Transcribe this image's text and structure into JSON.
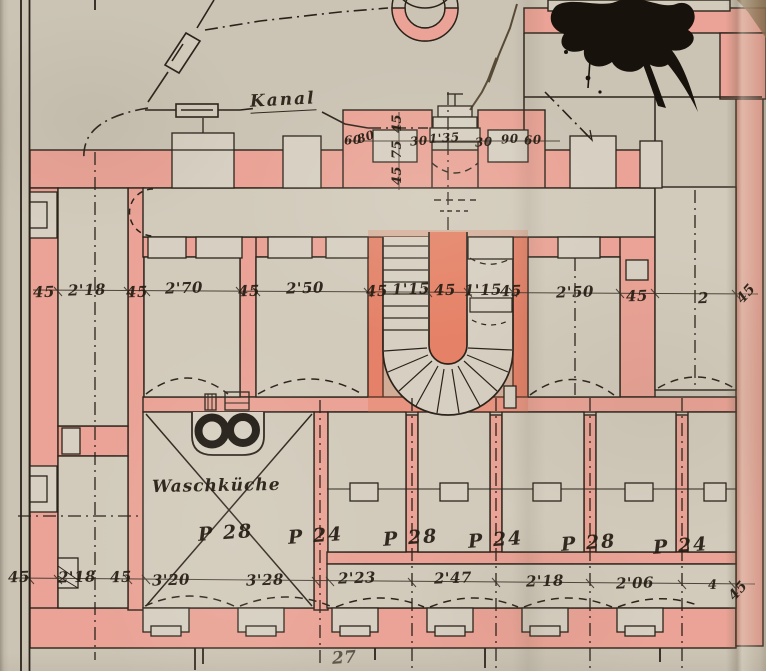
{
  "document": {
    "kind": "scanned hand-drawn basement floor plan",
    "colors": {
      "paper": "#cbc4b5",
      "wall_fill": "#eaa396",
      "wall_accent": "#e58a74",
      "ink": "#2b231a",
      "ink_blot": "#17120c"
    }
  },
  "labels": {
    "kanal": "Kanal",
    "waschkueche": "Waschküche",
    "page_number": "27"
  },
  "dimensions": {
    "top_row": [
      "60",
      "80",
      "30",
      "1'35",
      "30",
      "90",
      "60"
    ],
    "top_vertical": [
      "45",
      "75",
      "45"
    ],
    "middle_row": [
      "45",
      "2'18",
      "45",
      "2'70",
      "45",
      "2'50",
      "45",
      "1'15",
      "45",
      "1'15",
      "45",
      "2'50",
      "45",
      "2",
      "45"
    ],
    "bottom_row": [
      "45",
      "2'18",
      "45",
      "3'20",
      "3'28",
      "2'23",
      "2'47",
      "2'18",
      "2'06",
      "4",
      "45"
    ]
  },
  "room_numbers": [
    "P 28",
    "P 24",
    "P 28",
    "P 24",
    "P 28",
    "P 24"
  ]
}
